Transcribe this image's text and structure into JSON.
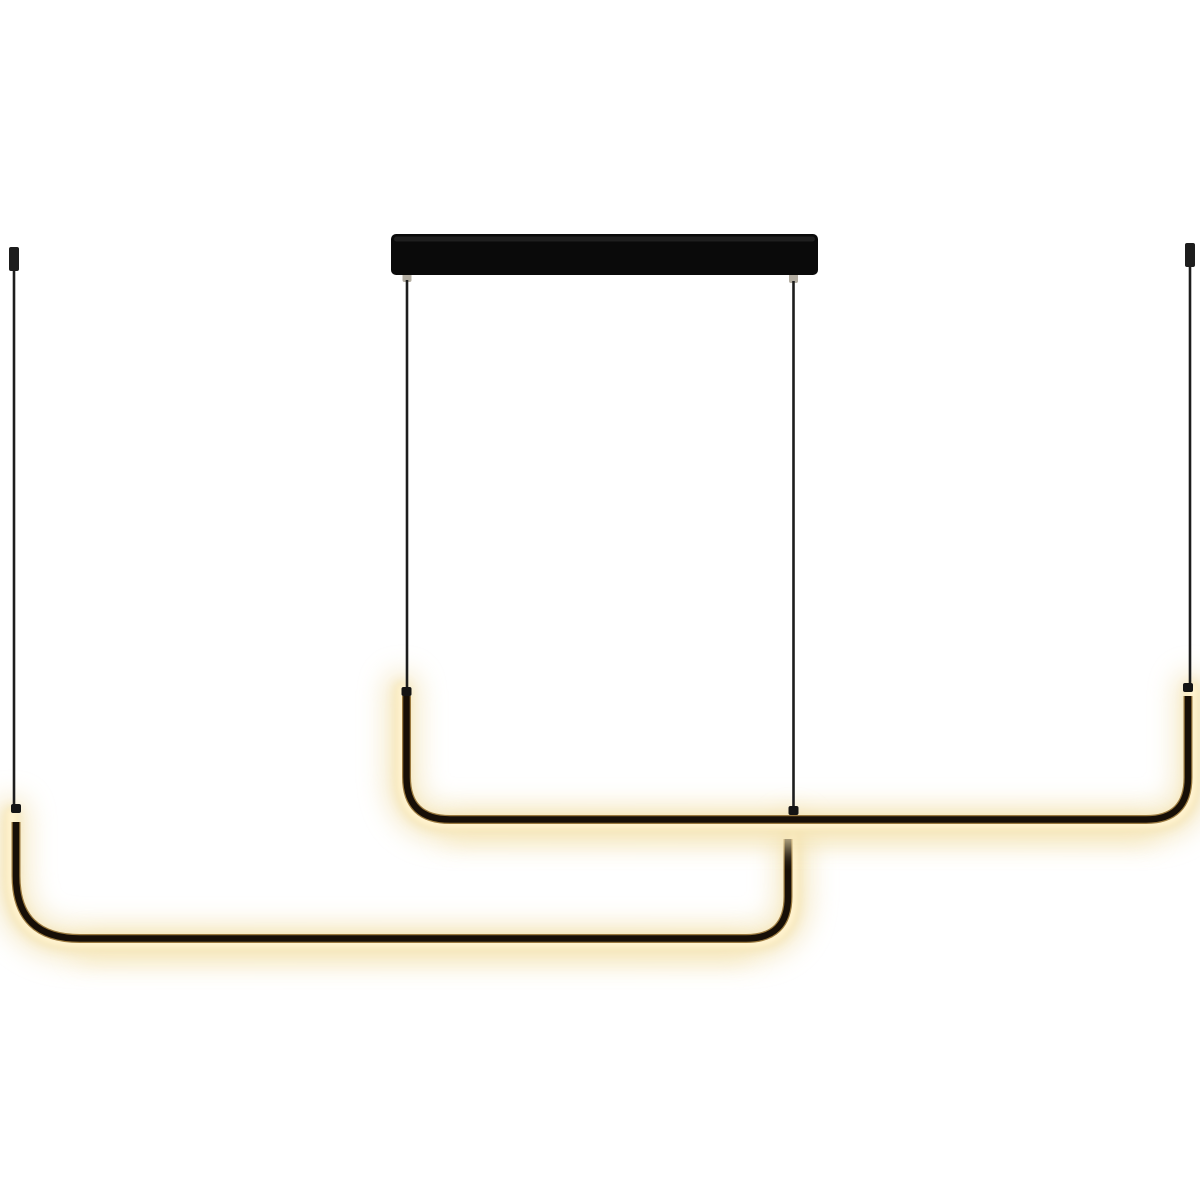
{
  "scene": {
    "description": "Product photo of a minimalist black linear LED pendant light: two offset right-angle glowing tube bars suspended by thin wires from a rectangular ceiling canopy and two separate ceiling points, on a plain white background",
    "product_type": "linear-pendant-lamp",
    "state": "lit",
    "parts": {
      "canopy": "rectangular black ceiling canopy bar",
      "ceiling_caps": [
        "left ceiling cap",
        "right ceiling cap"
      ],
      "wires": [
        "far-left suspension wire",
        "canopy left suspension wire",
        "canopy right suspension wire",
        "far-right suspension wire"
      ],
      "bars": [
        "upper U-shaped LED light bar",
        "lower U-shaped LED light bar"
      ],
      "connectors": [
        "canopy wire stubs",
        "wire-to-tube junction nodes"
      ]
    }
  },
  "colors": {
    "background": "#ffffff",
    "canopy_black": "#0a0a0a",
    "canopy_gloss": "#3a3a3a",
    "wire_black": "#1d1d1d",
    "tube_core": "#170f07",
    "tube_edge": "#8a6527",
    "glow_bright": "#fff3cf",
    "glow_mid": "#f6e6b8",
    "glow_soft": "#f1e0ae",
    "connector_gray": "#b3ada1",
    "node_black": "#141414"
  }
}
